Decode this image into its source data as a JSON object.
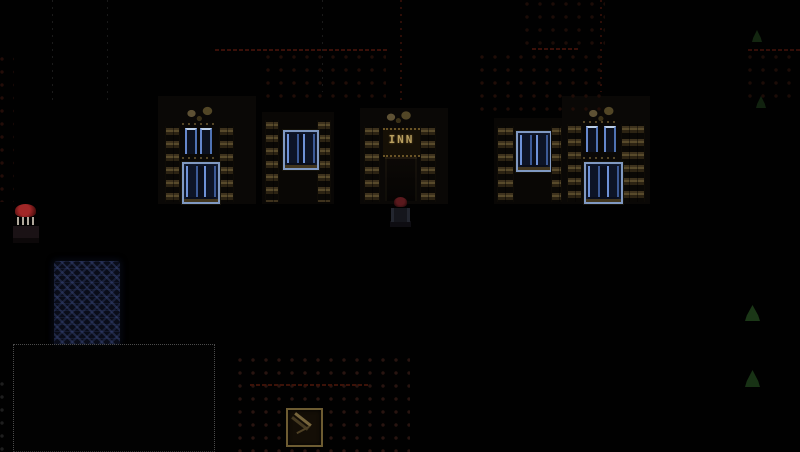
{
  "meta": {
    "description": "Dark night-time pixel-art RPG town scene with lit windows, an inn, a pond and path tiles",
    "viewport": {
      "width": 800,
      "height": 452
    },
    "background_color": "#010101"
  },
  "palette": {
    "window_glow_blue": "#6e92d8",
    "window_frame_blue": "#8099c2",
    "brick_tan": "#584a2b",
    "roof_line_red": "#3a1009",
    "sign_gold": "#b89f60",
    "npc_cap_red": "#a12727",
    "water_navy": "#0a0d1a",
    "bush_green": "#1e3d1a"
  },
  "scene": {
    "elements": [
      {
        "name": "left-house-wall",
        "type": "rect",
        "x": 158,
        "y": 96,
        "w": 98,
        "h": 108,
        "color": "#0a0806",
        "interactable": false
      },
      {
        "name": "mid-house-wall",
        "type": "rect",
        "x": 262,
        "y": 112,
        "w": 72,
        "h": 92,
        "color": "#090705",
        "interactable": false
      },
      {
        "name": "inn-wall",
        "type": "rect",
        "x": 360,
        "y": 108,
        "w": 88,
        "h": 96,
        "color": "#0a0806",
        "interactable": false
      },
      {
        "name": "right-small-house-wall",
        "type": "rect",
        "x": 494,
        "y": 118,
        "w": 72,
        "h": 86,
        "color": "#090705",
        "interactable": false
      },
      {
        "name": "right-house-wall",
        "type": "rect",
        "x": 562,
        "y": 96,
        "w": 88,
        "h": 108,
        "color": "#0a0806",
        "interactable": false
      },
      {
        "name": "roof-eave-line-center",
        "type": "hline",
        "x": 215,
        "y": 49,
        "w": 172,
        "h": 2,
        "color": "#3a1009",
        "interactable": false
      },
      {
        "name": "roof-eave-line-mid-right",
        "type": "hline",
        "x": 532,
        "y": 48,
        "w": 46,
        "h": 2,
        "color": "#3a1009",
        "interactable": false
      },
      {
        "name": "roof-eave-line-far-right",
        "type": "hline",
        "x": 748,
        "y": 49,
        "w": 52,
        "h": 2,
        "color": "#330e08",
        "interactable": false
      },
      {
        "name": "wall-seam-dotted-1",
        "type": "vline",
        "x": 52,
        "y": 0,
        "w": 1,
        "h": 105,
        "color": "#1b1b1b",
        "interactable": false
      },
      {
        "name": "wall-seam-dotted-2",
        "type": "vline",
        "x": 107,
        "y": 0,
        "w": 1,
        "h": 105,
        "color": "#191919",
        "interactable": false
      },
      {
        "name": "wall-seam-dotted-3",
        "type": "vline",
        "x": 322,
        "y": 0,
        "w": 1,
        "h": 92,
        "color": "#1a1a1a",
        "interactable": false
      },
      {
        "name": "roof-ridge-dotted-red-1",
        "type": "vline",
        "x": 400,
        "y": 0,
        "w": 2,
        "h": 105,
        "color": "#2e0d07",
        "interactable": false
      },
      {
        "name": "roof-ridge-dotted-red-2",
        "type": "vline",
        "x": 600,
        "y": 0,
        "w": 2,
        "h": 92,
        "color": "#2e0d07",
        "interactable": false
      },
      {
        "name": "roof-shingles-center",
        "type": "dotgrid",
        "x": 266,
        "y": 55,
        "w": 120,
        "h": 46,
        "color": "#200d07",
        "interactable": false
      },
      {
        "name": "roof-shingles-upper-mid",
        "type": "dotgrid",
        "x": 525,
        "y": 2,
        "w": 80,
        "h": 50,
        "color": "#1c0c07",
        "interactable": false
      },
      {
        "name": "roof-shingles-mid-right",
        "type": "dotgrid",
        "x": 480,
        "y": 55,
        "w": 125,
        "h": 62,
        "color": "#200d07",
        "interactable": false
      },
      {
        "name": "roof-shingles-far-right",
        "type": "dotgrid",
        "x": 748,
        "y": 55,
        "w": 52,
        "h": 46,
        "color": "#1c0c07",
        "interactable": false
      },
      {
        "name": "roof-shingles-left-edge",
        "type": "dotgrid",
        "x": 0,
        "y": 57,
        "w": 14,
        "h": 145,
        "color": "#230d08",
        "interactable": false
      },
      {
        "name": "left-house-gable-ornament",
        "type": "gable",
        "x": 183,
        "y": 103,
        "w": 34,
        "h": 19,
        "interactable": false
      },
      {
        "name": "left-house-brick-left",
        "type": "brick-column",
        "x": 165,
        "y": 126,
        "w": 15,
        "h": 76,
        "interactable": false
      },
      {
        "name": "left-house-brick-right",
        "type": "brick-column",
        "x": 219,
        "y": 126,
        "w": 15,
        "h": 76,
        "interactable": false
      },
      {
        "name": "left-house-window-upper",
        "type": "window-upper",
        "x": 182,
        "y": 123,
        "w": 33,
        "h": 36,
        "interactable": false
      },
      {
        "name": "left-house-window-lower",
        "type": "window-lower",
        "x": 182,
        "y": 162,
        "w": 34,
        "h": 38,
        "interactable": false
      },
      {
        "name": "mid-house-brick-left",
        "type": "brick-column",
        "x": 265,
        "y": 120,
        "w": 14,
        "h": 82,
        "interactable": false
      },
      {
        "name": "mid-house-brick-right",
        "type": "brick-column",
        "x": 317,
        "y": 120,
        "w": 14,
        "h": 82,
        "interactable": false
      },
      {
        "name": "mid-house-window",
        "type": "window-lower",
        "x": 283,
        "y": 130,
        "w": 32,
        "h": 36,
        "interactable": false
      },
      {
        "name": "inn-gable-ornament",
        "type": "gable",
        "x": 383,
        "y": 110,
        "w": 32,
        "h": 13,
        "interactable": false
      },
      {
        "name": "inn-brick-left",
        "type": "brick-column",
        "x": 364,
        "y": 126,
        "w": 16,
        "h": 76,
        "interactable": false
      },
      {
        "name": "inn-brick-right",
        "type": "brick-column",
        "x": 420,
        "y": 126,
        "w": 16,
        "h": 76,
        "interactable": false
      },
      {
        "name": "inn-sign",
        "type": "sign-inn",
        "x": 383,
        "y": 128,
        "w": 37,
        "h": 25,
        "text": "INN",
        "interactable": true
      },
      {
        "name": "inn-door",
        "type": "door",
        "x": 385,
        "y": 157,
        "w": 32,
        "h": 44,
        "interactable": true
      },
      {
        "name": "right-small-house-brick-left",
        "type": "brick-column",
        "x": 497,
        "y": 126,
        "w": 17,
        "h": 76,
        "interactable": false
      },
      {
        "name": "right-small-house-window",
        "type": "window-lower",
        "x": 516,
        "y": 131,
        "w": 32,
        "h": 37,
        "interactable": false
      },
      {
        "name": "right-small-house-brick-right",
        "type": "brick-column",
        "x": 551,
        "y": 126,
        "w": 11,
        "h": 76,
        "interactable": false
      },
      {
        "name": "right-house-gable-ornament",
        "type": "gable",
        "x": 585,
        "y": 103,
        "w": 33,
        "h": 19,
        "interactable": false
      },
      {
        "name": "right-house-brick-left",
        "type": "brick-column",
        "x": 567,
        "y": 124,
        "w": 15,
        "h": 78,
        "interactable": false
      },
      {
        "name": "right-house-brick-right",
        "type": "brick-column",
        "x": 621,
        "y": 124,
        "w": 24,
        "h": 78,
        "interactable": false
      },
      {
        "name": "right-house-window-upper",
        "type": "window-upper",
        "x": 583,
        "y": 121,
        "w": 36,
        "h": 38,
        "interactable": false
      },
      {
        "name": "right-house-window-lower",
        "type": "window-lower",
        "x": 584,
        "y": 162,
        "w": 35,
        "h": 38,
        "interactable": false
      },
      {
        "name": "npc-red-cap",
        "type": "npc",
        "x": 13,
        "y": 203,
        "w": 26,
        "h": 40,
        "interactable": true
      },
      {
        "name": "player-character",
        "type": "player",
        "x": 390,
        "y": 197,
        "w": 21,
        "h": 33,
        "interactable": true
      },
      {
        "name": "pond",
        "type": "water",
        "x": 54,
        "y": 261,
        "w": 66,
        "h": 84,
        "interactable": false
      },
      {
        "name": "fenced-yard",
        "type": "fence",
        "x": 13,
        "y": 344,
        "w": 200,
        "h": 106,
        "interactable": false
      },
      {
        "name": "fence-posts-left-edge",
        "type": "dotgrid",
        "x": 0,
        "y": 382,
        "w": 12,
        "h": 70,
        "color": "#1e1e1e",
        "interactable": false
      },
      {
        "name": "plaza-tiles",
        "type": "dotgrid",
        "x": 238,
        "y": 358,
        "w": 172,
        "h": 94,
        "color": "#281410",
        "interactable": false
      },
      {
        "name": "plaza-edge-dotted-line",
        "type": "hline",
        "x": 250,
        "y": 384,
        "w": 120,
        "h": 2,
        "color": "#3c1208",
        "interactable": false
      },
      {
        "name": "street-sign-tile",
        "type": "sign-tile",
        "x": 286,
        "y": 408,
        "w": 33,
        "h": 35,
        "interactable": true
      },
      {
        "name": "bush-right-top",
        "type": "tree",
        "x": 752,
        "y": 30,
        "w": 10,
        "h": 12,
        "color": "#152a12",
        "interactable": false
      },
      {
        "name": "bush-right-mid",
        "type": "tree",
        "x": 756,
        "y": 96,
        "w": 10,
        "h": 12,
        "color": "#132611",
        "interactable": false
      },
      {
        "name": "bush-right-upper",
        "type": "tree",
        "x": 745,
        "y": 305,
        "w": 15,
        "h": 16,
        "color": "#1e3d1a",
        "interactable": false
      },
      {
        "name": "bush-right-lower",
        "type": "tree",
        "x": 745,
        "y": 370,
        "w": 15,
        "h": 17,
        "color": "#1b3717",
        "interactable": false
      }
    ]
  }
}
